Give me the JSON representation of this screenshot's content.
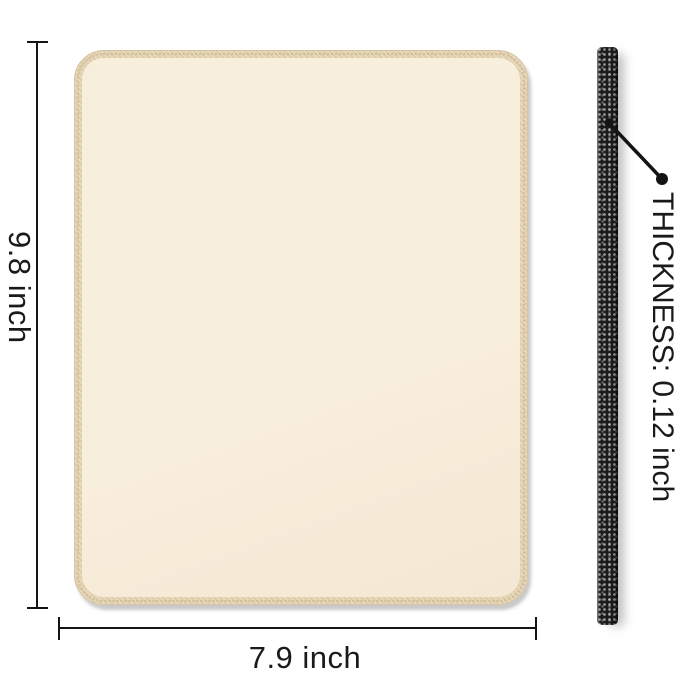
{
  "labels": {
    "height": "9.8 inch",
    "width": "7.9 inch",
    "thickness": "THICKNESS: 0.12 inch"
  },
  "product": {
    "view_top": "mouse pad top view with stitched edge",
    "view_side": "mouse pad side edge strip"
  },
  "colors": {
    "background": "#ffffff",
    "line": "#141414",
    "text": "#1a1a1a",
    "pad-surface": "#f8eedc",
    "pad-edge": "#e8d9bc",
    "pad-edge-stitch": "#cfbb93",
    "strip": "#1b1b1b"
  }
}
